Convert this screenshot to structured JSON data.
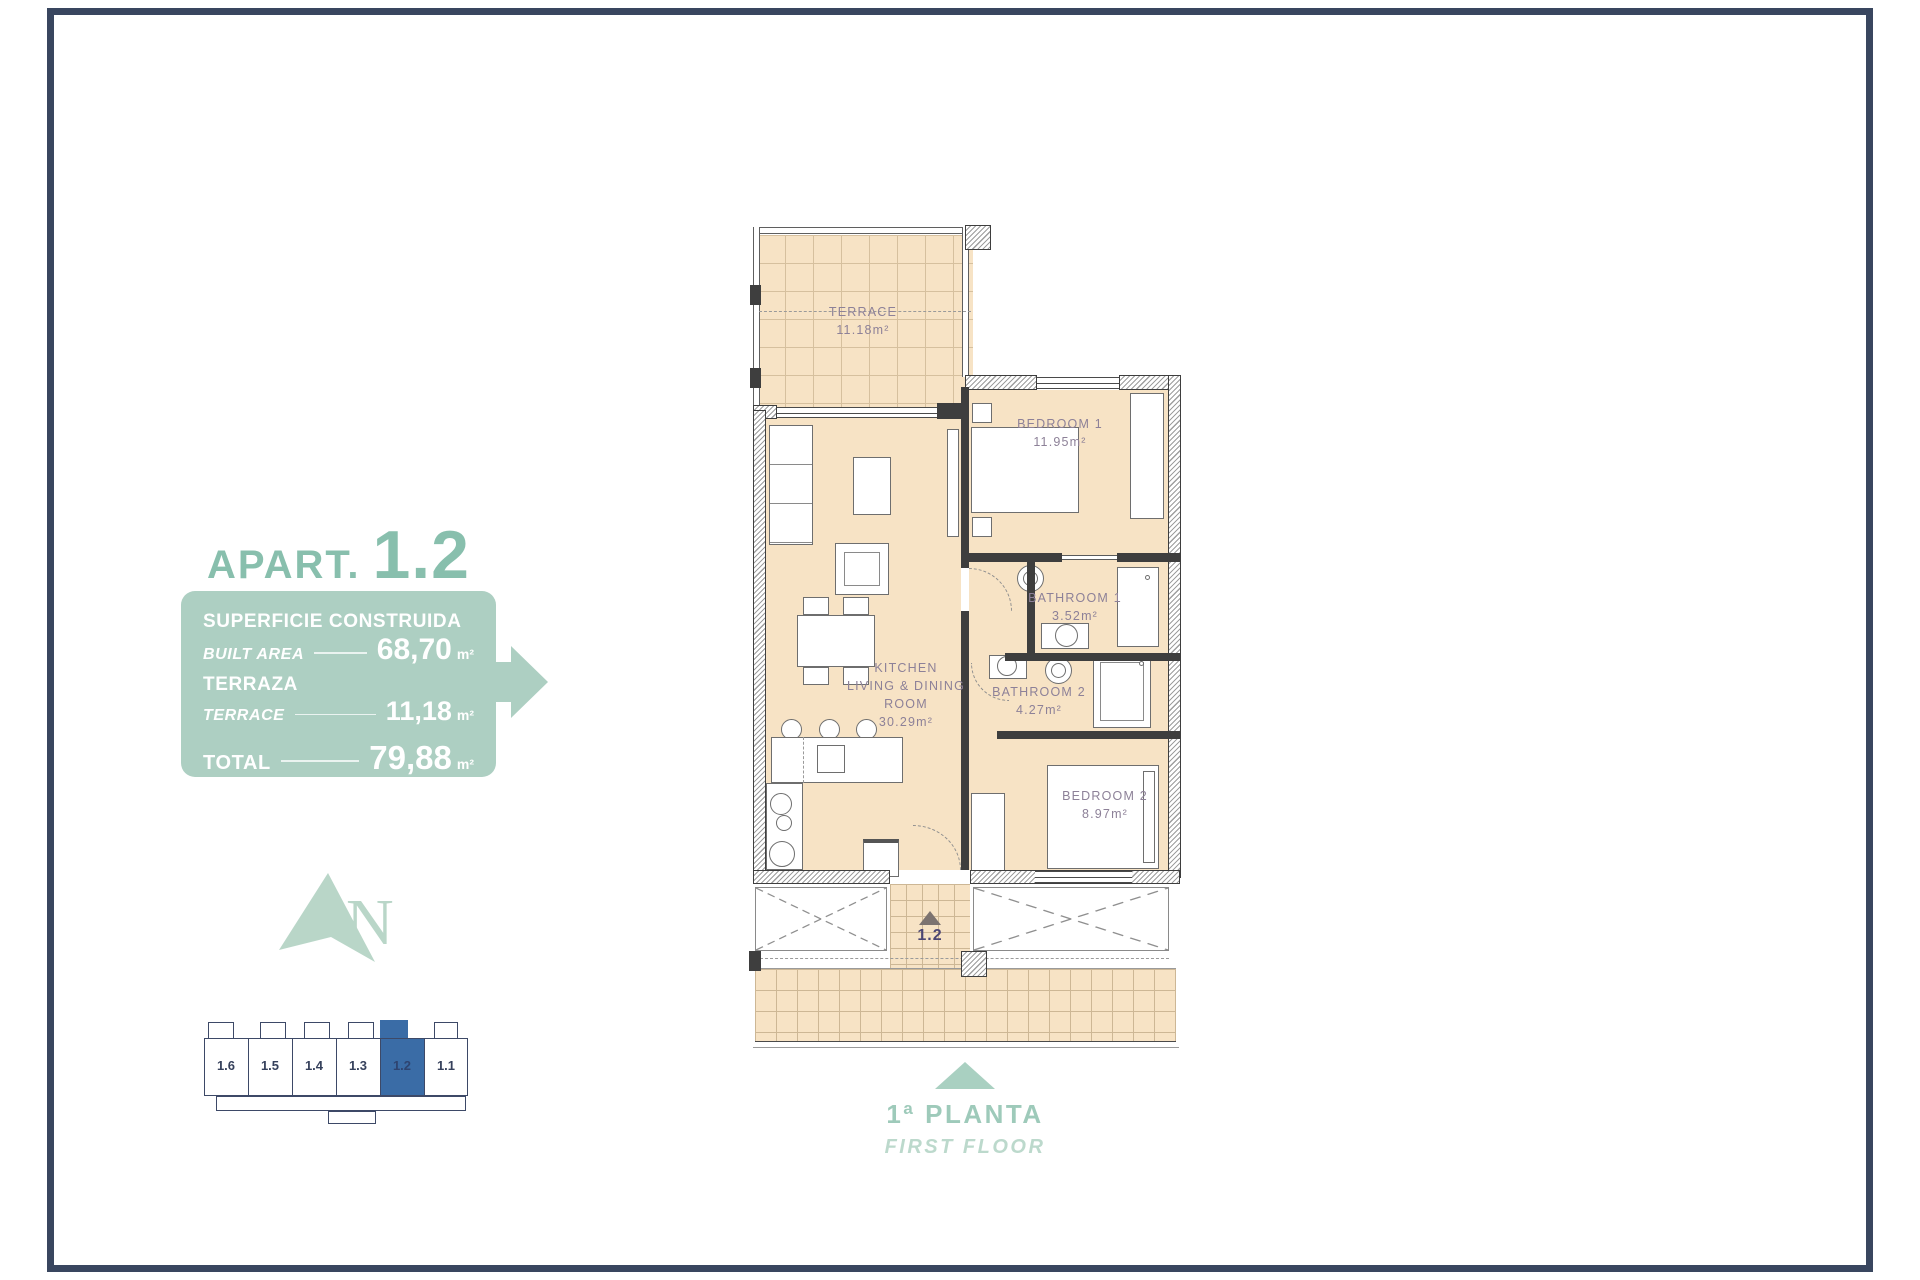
{
  "title": {
    "prefix": "APART.",
    "number": "1.2"
  },
  "summary": {
    "built_area": {
      "label_primary": "SUPERFICIE CONSTRUIDA",
      "label_secondary": "BUILT AREA",
      "value": "68,70",
      "unit": "m²"
    },
    "terrace": {
      "label_primary": "TERRAZA",
      "label_secondary": "TERRACE",
      "value": "11,18",
      "unit": "m²"
    },
    "total": {
      "label_primary": "TOTAL",
      "value": "79,88",
      "unit": "m²"
    }
  },
  "compass": {
    "letter": "N"
  },
  "key_plan": {
    "units": [
      "1.6",
      "1.5",
      "1.4",
      "1.3",
      "1.2",
      "1.1"
    ],
    "highlighted_unit": "1.2"
  },
  "plan": {
    "terrace": {
      "name": "TERRACE",
      "area": "11.18m²"
    },
    "bedroom1": {
      "name": "BEDROOM 1",
      "area": "11.95m²"
    },
    "bathroom1": {
      "name": "BATHROOM 1",
      "area": "3.52m²"
    },
    "bathroom2": {
      "name": "BATHROOM 2",
      "area": "4.27m²"
    },
    "bedroom2": {
      "name": "BEDROOM 2",
      "area": "8.97m²"
    },
    "kitchen": {
      "name_line1": "KITCHEN",
      "name_line2": "LIVING & DINING",
      "name_line3": "ROOM",
      "area": "30.29m²"
    },
    "entrance_unit": "1.2"
  },
  "footer": {
    "floor_primary": "1ª PLANTA",
    "floor_secondary": "FIRST FLOOR"
  },
  "colors": {
    "accent": "#88bfad",
    "panel": "#adcfc2",
    "highlight": "#3a6ca6",
    "floor_fill": "#f7e3c5",
    "frame": "#39465f"
  }
}
